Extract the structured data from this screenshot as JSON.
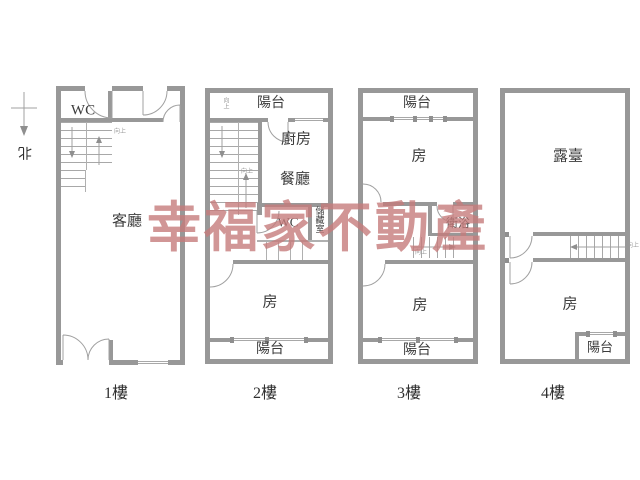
{
  "watermark": {
    "text": "幸福家不動產",
    "color": "#c67c7c"
  },
  "north": {
    "label": "北"
  },
  "floor1": {
    "label": "1樓",
    "wc": "WC",
    "living_room": "客廳",
    "stairs_note": "向上"
  },
  "floor2": {
    "label": "2樓",
    "balcony_top": "陽台",
    "kitchen": "廚房",
    "dining_room": "餐廳",
    "wc": "WC",
    "storage": "儲藏室",
    "room": "房",
    "balcony_bottom": "陽台",
    "stairs_note": "向上"
  },
  "floor3": {
    "label": "3樓",
    "balcony_top": "陽台",
    "room_front": "房",
    "bathroom": "衛浴",
    "room_back": "房",
    "balcony_bottom": "陽台",
    "stairs_note": "向上"
  },
  "floor4": {
    "label": "4樓",
    "terrace": "露臺",
    "room": "房",
    "balcony": "陽台",
    "stairs_note": "向上"
  }
}
